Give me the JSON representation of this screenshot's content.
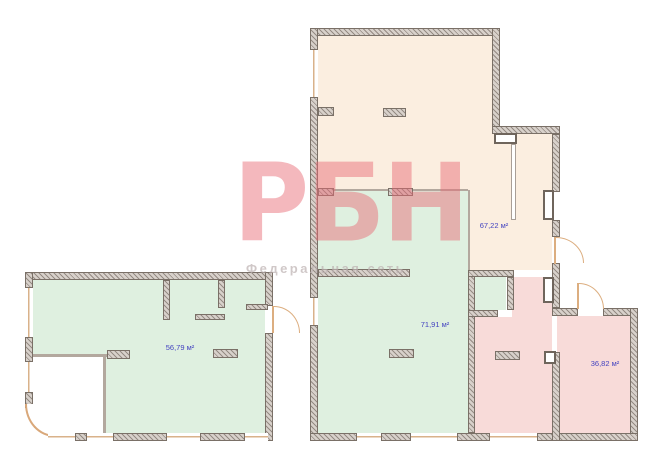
{
  "watermark": {
    "logo": "РБН",
    "subtitle": "Федеральная сеть",
    "logo_color": "#e86b75"
  },
  "rooms": [
    {
      "name": "upper-room",
      "area": "67,22 м²",
      "fill": "#fbeee0"
    },
    {
      "name": "main-green-room",
      "area": "71,91 м²",
      "fill": "#dff0e0"
    },
    {
      "name": "left-green-room",
      "area": "56,79 м²",
      "fill": "#dff0e0"
    },
    {
      "name": "small-green-room",
      "area": "",
      "fill": "#dff0e0"
    },
    {
      "name": "pink-room",
      "area": "36,82 м²",
      "fill": "#f8dbd9"
    },
    {
      "name": "pink-corridor",
      "area": "",
      "fill": "#f8dbd9"
    }
  ],
  "colors": {
    "wall_fill": "#d8d1cb",
    "wall_hatch": "#958b84",
    "wall_border": "#7a7067",
    "door": "#dcae80",
    "window_sill": "#d9b28a",
    "label_text": "#4343c0"
  }
}
